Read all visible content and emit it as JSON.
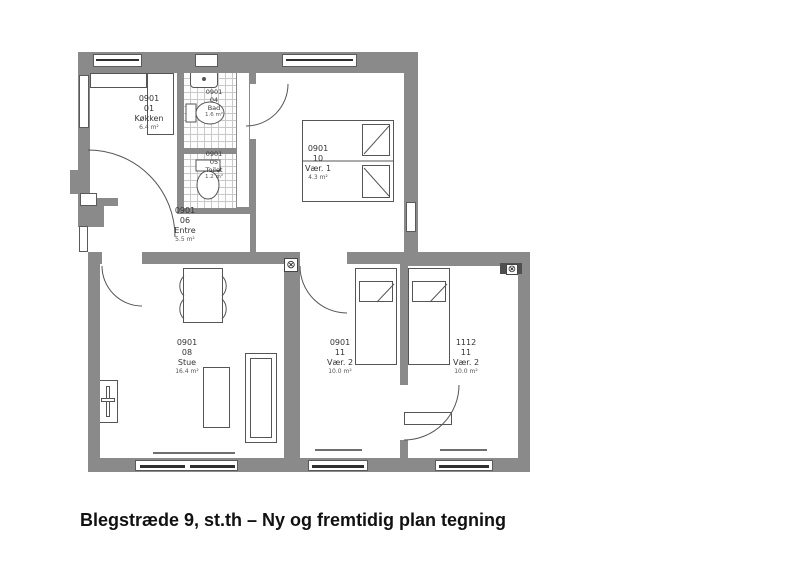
{
  "caption": "Blegstræde 9, st.th – Ny og fremtidig plan tegning",
  "symbols": {
    "vent": "⊗"
  },
  "colors": {
    "wall": "#8a8a8a",
    "fixture_line": "#555555",
    "tile_line": "#c9c9c9",
    "label_text": "#333333",
    "caption_text": "#111111"
  },
  "plan": {
    "rooms": {
      "koekken": {
        "id": "0901",
        "no": "01",
        "name": "Køkken",
        "area": "6.4 m²"
      },
      "bad": {
        "id": "0901",
        "no": "04",
        "name": "Bad",
        "area": "1.6 m²"
      },
      "toilet": {
        "id": "0901",
        "no": "05",
        "name": "Toilet",
        "area": "1.2 m²"
      },
      "vaer1": {
        "id": "0901",
        "no": "10",
        "name": "Vær. 1",
        "area": "4.3 m²"
      },
      "entre": {
        "id": "0901",
        "no": "06",
        "name": "Entre",
        "area": "5.5 m²"
      },
      "stue": {
        "id": "0901",
        "no": "08",
        "name": "Stue",
        "area": "16.4 m²"
      },
      "vaer2a": {
        "id": "0901",
        "no": "11",
        "name": "Vær. 2",
        "area": "10.0 m²"
      },
      "vaer2b": {
        "id": "1112",
        "no": "11",
        "name": "Vær. 2",
        "area": "10.0 m²"
      }
    }
  }
}
